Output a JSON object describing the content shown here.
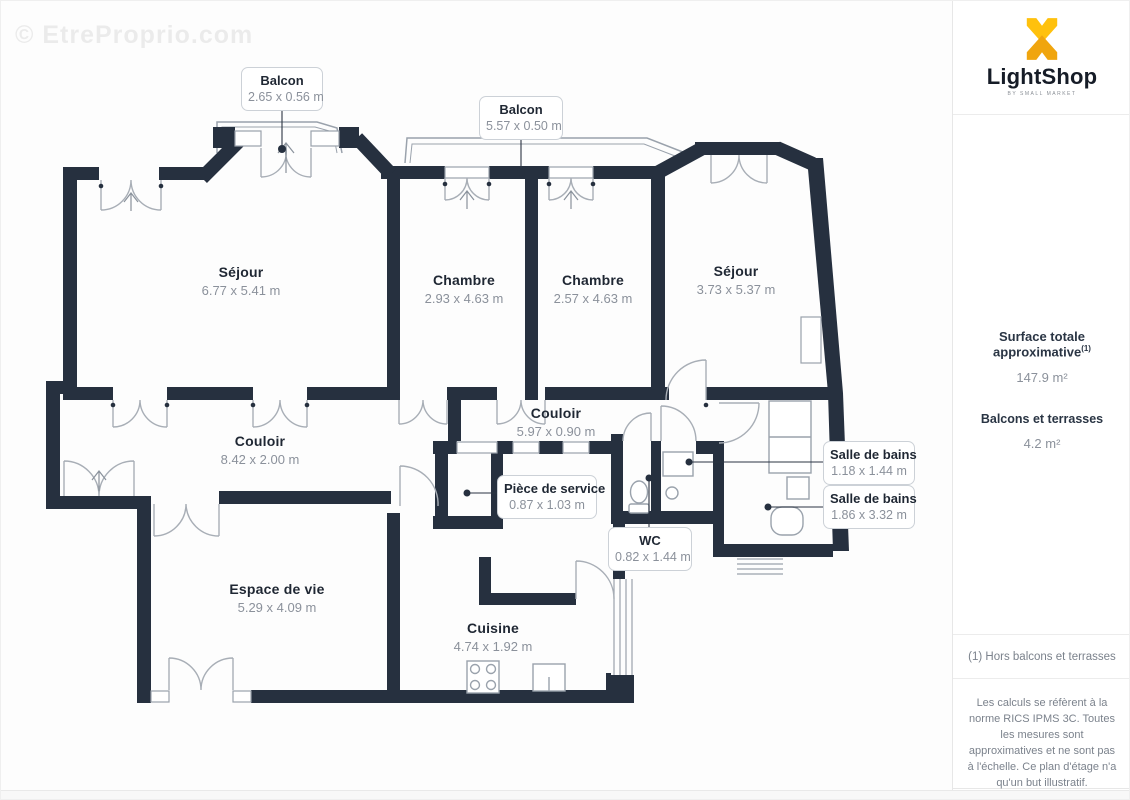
{
  "watermark": "© EtreProprio.com",
  "plan": {
    "callouts": [
      {
        "title": "Balcon",
        "dims": "2.65 x 0.56 m"
      },
      {
        "title": "Balcon",
        "dims": "5.57 x 0.50 m"
      },
      {
        "title": "Pièce de service",
        "dims": "0.87 x 1.03 m"
      },
      {
        "title": "WC",
        "dims": "0.82 x 1.44 m"
      },
      {
        "title": "Salle de bains",
        "dims": "1.18 x 1.44 m"
      },
      {
        "title": "Salle de bains",
        "dims": "1.86 x 3.32 m"
      }
    ],
    "rooms": [
      {
        "name": "Séjour",
        "dims": "6.77 x 5.41 m"
      },
      {
        "name": "Chambre",
        "dims": "2.93 x 4.63 m"
      },
      {
        "name": "Chambre",
        "dims": "2.57 x 4.63 m"
      },
      {
        "name": "Séjour",
        "dims": "3.73 x 5.37 m"
      },
      {
        "name": "Couloir",
        "dims": "8.42 x 2.00 m"
      },
      {
        "name": "Couloir",
        "dims": "5.97 x 0.90 m"
      },
      {
        "name": "Espace de vie",
        "dims": "5.29 x 4.09 m"
      },
      {
        "name": "Cuisine",
        "dims": "4.74 x 1.92 m"
      }
    ]
  },
  "sidebar": {
    "brand": "LightShop",
    "tagline": "BY SMALL MARKET",
    "surface_title": "Surface totale approximative",
    "surface_footnote_marker": "(1)",
    "surface_value": "147.9 m²",
    "balconies_label": "Balcons et terrasses",
    "balconies_value": "4.2 m²",
    "footnote": "(1) Hors balcons et terrasses",
    "disclaimer": "Les calculs se réfèrent à la norme RICS IPMS 3C. Toutes les mesures sont approximatives et ne sont pas à l'échelle. Ce plan d'étage n'a qu'un but illustratif.",
    "footer_brand": "GIRAFFE",
    "footer_brand_bold": "360"
  },
  "colors": {
    "wall": "#26303f",
    "arc": "#a8aeb6",
    "accent_gold": "#FFC10D",
    "accent_gold_dark": "#F0A50E"
  }
}
